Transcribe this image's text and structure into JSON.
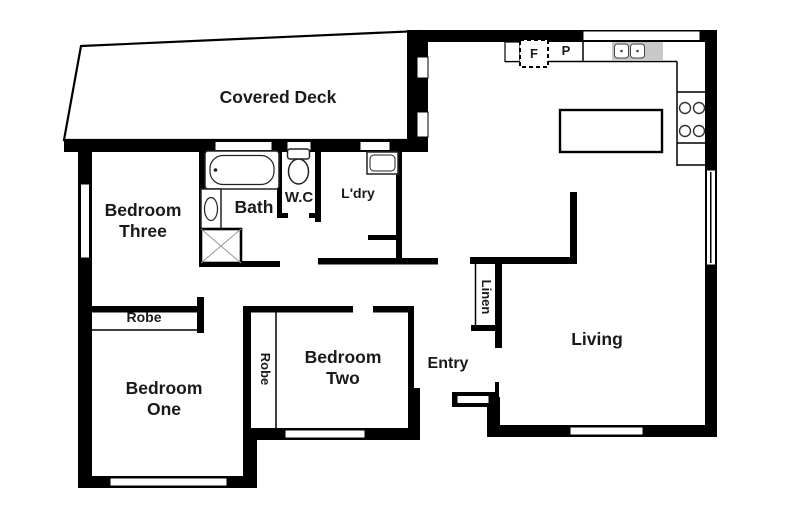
{
  "page": {
    "title": "Residential floor plan",
    "width_px": 790,
    "height_px": 527
  },
  "colors": {
    "wall": "#000000",
    "background": "#ffffff",
    "fixture_outline": "#222222",
    "sink_drainer": "#c8c8c8"
  },
  "labels": {
    "covered_deck": "Covered Deck",
    "bedroom_three_line1": "Bedroom",
    "bedroom_three_line2": "Three",
    "bath": "Bath",
    "wc": "W.C",
    "laundry": "L'dry",
    "fridge": "F",
    "pantry": "P",
    "living": "Living",
    "linen": "Linen",
    "entry": "Entry",
    "robe_bedroom_one": "Robe",
    "robe_bedroom_two": "Robe",
    "bedroom_one_line1": "Bedroom",
    "bedroom_one_line2": "One",
    "bedroom_two_line1": "Bedroom",
    "bedroom_two_line2": "Two"
  },
  "rooms": [
    "Covered Deck",
    "Bedroom Three",
    "Bath",
    "W.C",
    "L'dry",
    "Living",
    "Entry",
    "Linen",
    "Bedroom One",
    "Bedroom Two"
  ],
  "fixtures": [
    "bathtub",
    "vanity-basin",
    "shower",
    "toilet",
    "laundry-trough",
    "kitchen-sink",
    "cooktop",
    "island-bench",
    "fridge-space",
    "pantry"
  ]
}
